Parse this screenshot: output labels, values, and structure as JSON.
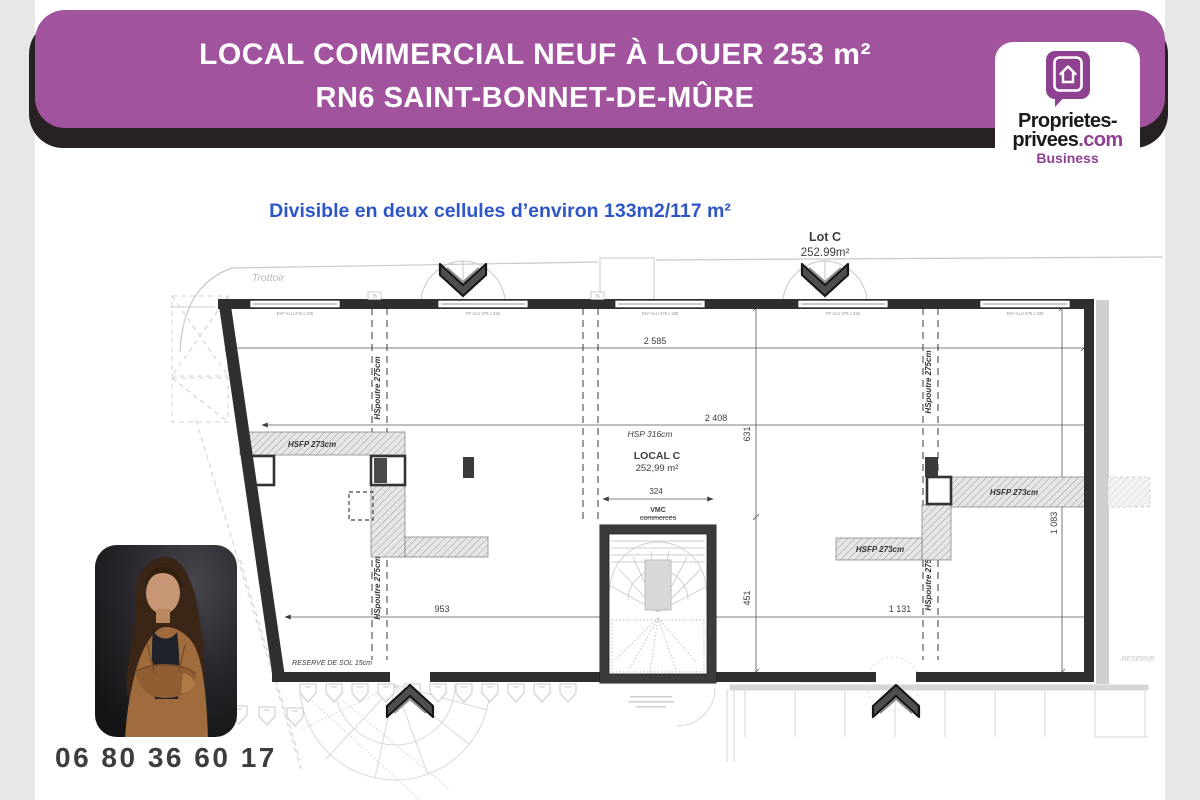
{
  "banner": {
    "line1": "LOCAL COMMERCIAL NEUF À LOUER 253 m²",
    "line2": "RN6 SAINT-BONNET-DE-MÛRE",
    "bg_color": "#a2539e",
    "shadow_color": "#282123"
  },
  "logo": {
    "line1": "Proprietes-",
    "line2_black": "privees",
    "line2_accent": ".com",
    "line3": "Business",
    "accent_color": "#8e4191"
  },
  "subtitle": {
    "text": "Divisible en deux cellules d’environ 133m2/117 m²",
    "color": "#2e56c7"
  },
  "contact": {
    "phone": "06 80 36 60 17"
  },
  "plan": {
    "trottoir": "Trottoir",
    "lot_title": "Lot C",
    "lot_area": "252.99m²",
    "local_title": "LOCAL C",
    "local_area": "252,99 m²",
    "hsp": "HSP 316cm",
    "dim_2585": "2 585",
    "dim_2408": "2 408",
    "dim_631": "631",
    "dim_451": "451",
    "dim_953": "953",
    "dim_1131": "1 131",
    "dim_1083": "1 083",
    "dim_324": "324",
    "beam_hsfp": "HSFP 273cm",
    "beam_hspoutre": "HSpoutre 275cm",
    "vmc1": "VMC",
    "vmc2": "commerces",
    "reserve_sol": "RESERVE DE SOL 15cm",
    "reserve": "RESERVE",
    "win_dif": "DI-F ALU 275 x 225",
    "win_pf": "PF ALU 275 x 225",
    "tag75": "75"
  }
}
